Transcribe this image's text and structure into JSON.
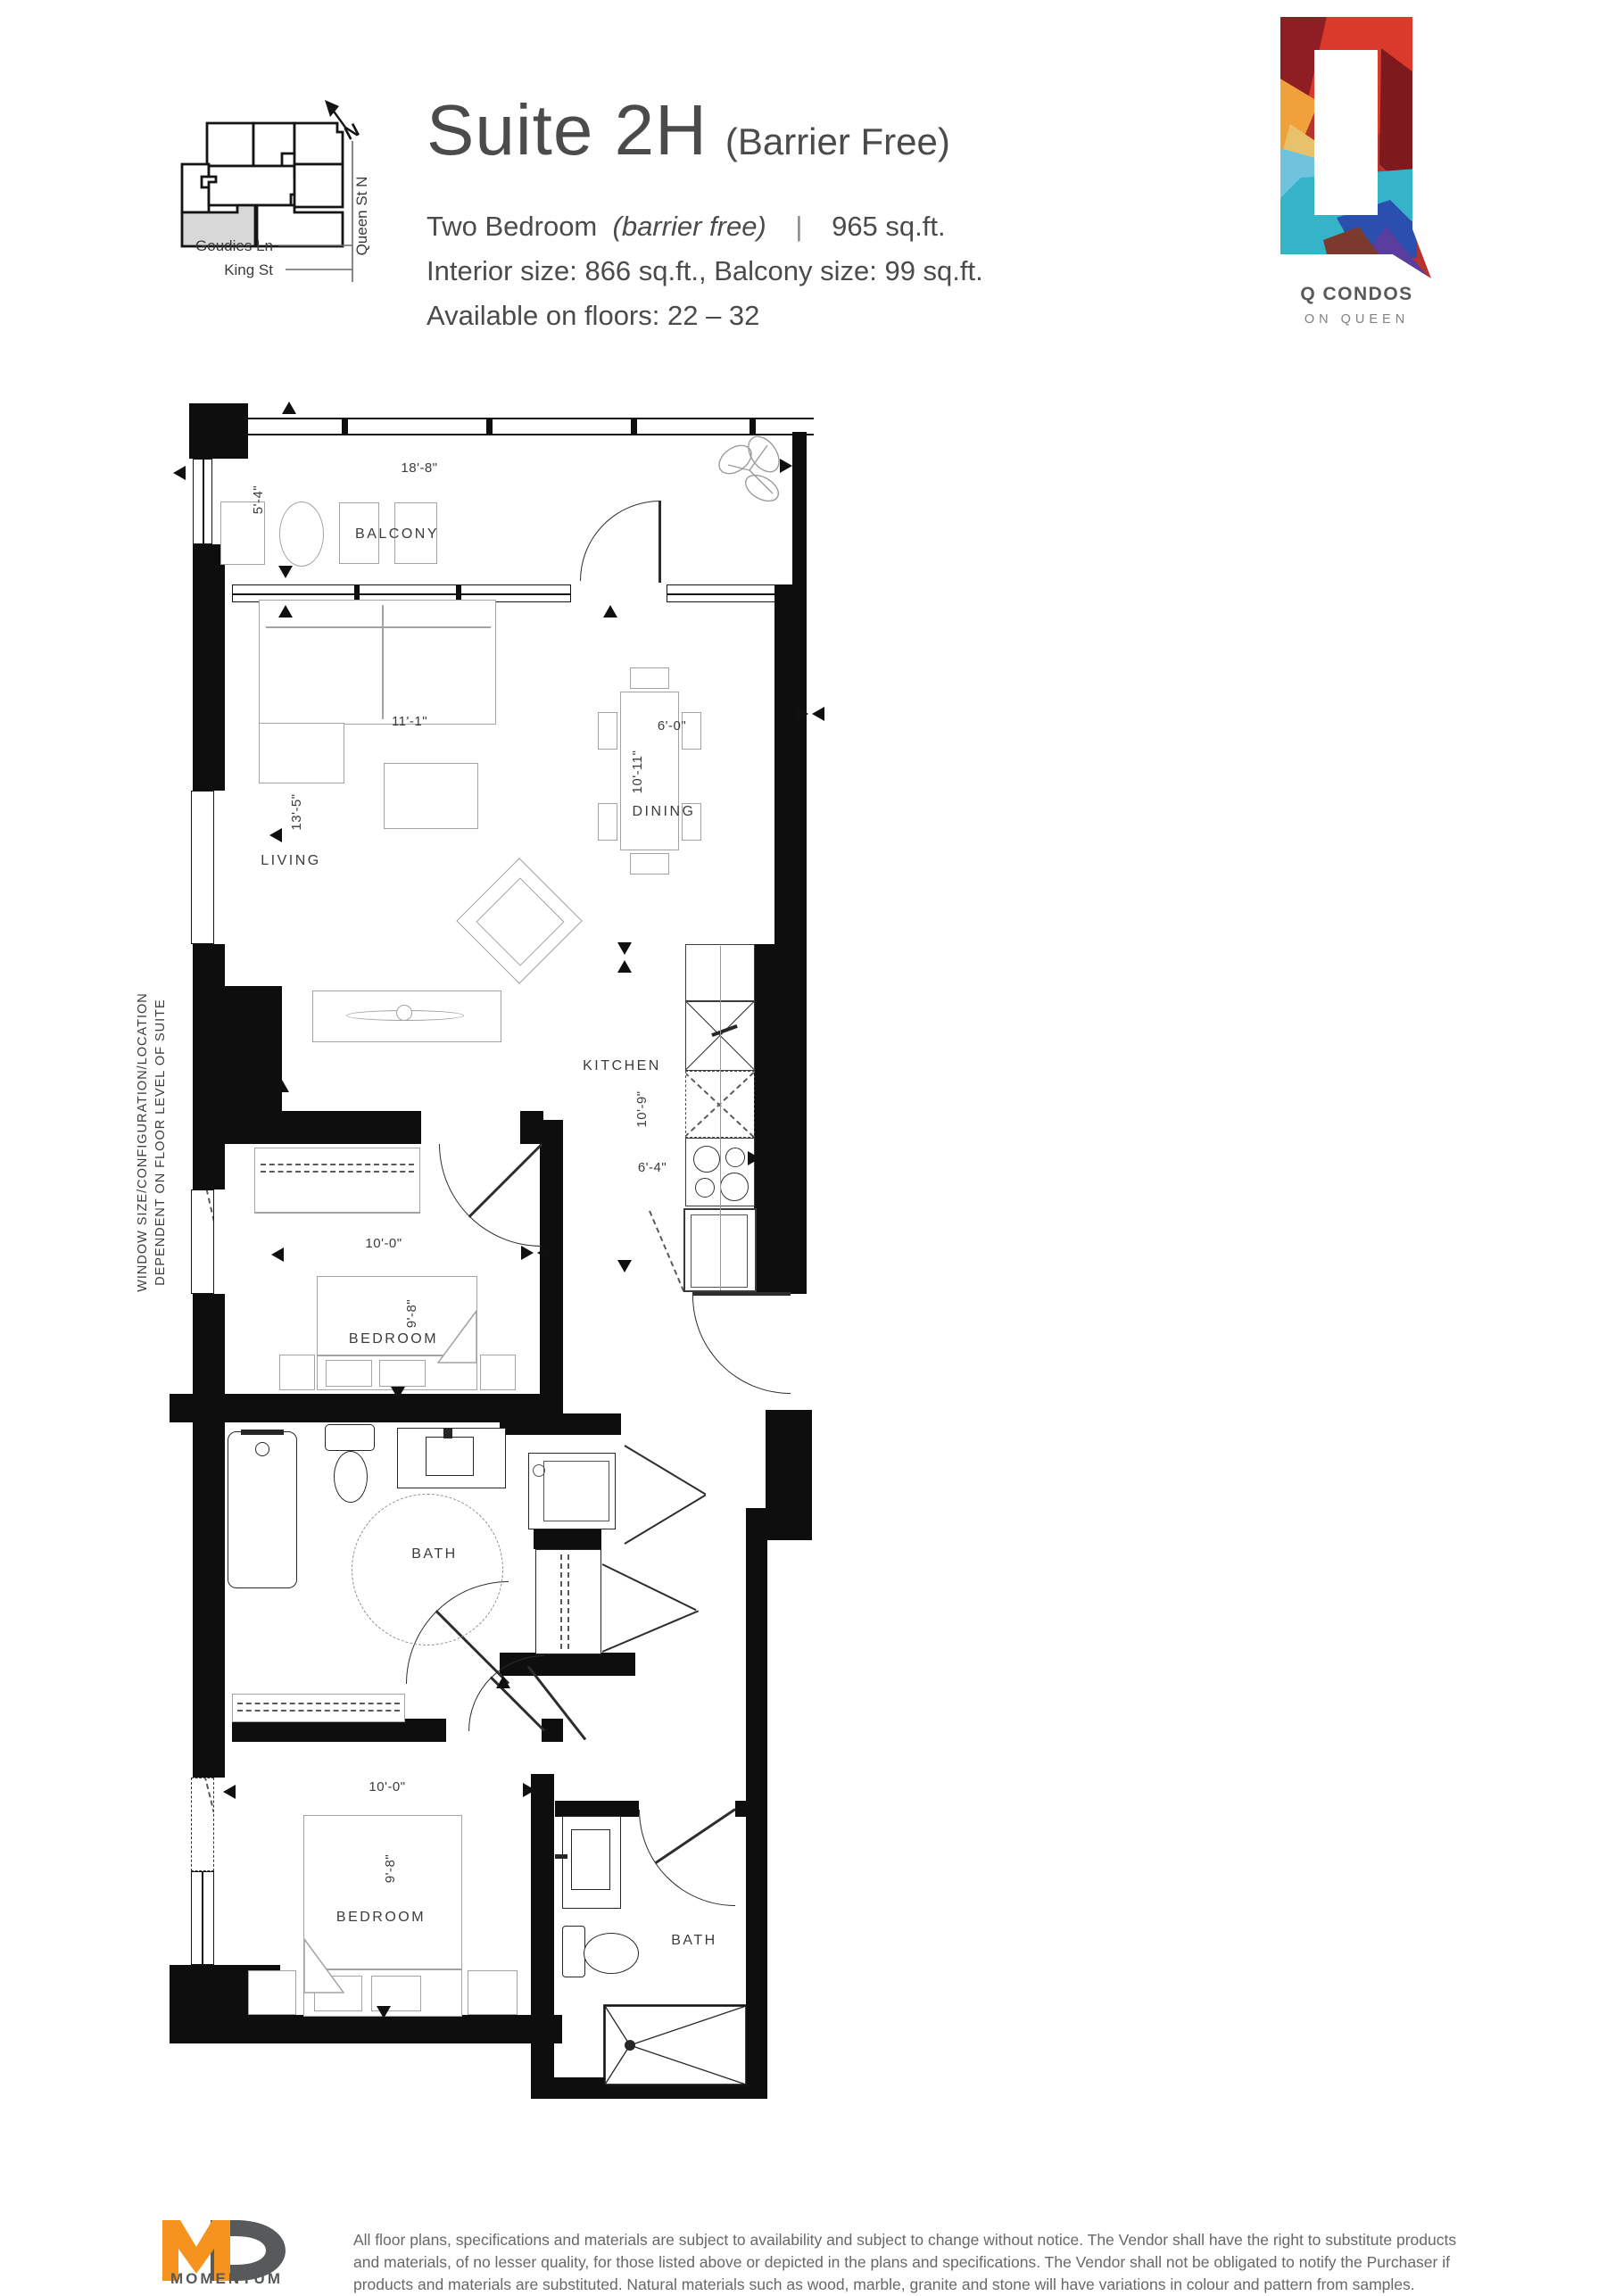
{
  "header": {
    "suite": "Suite 2H",
    "qualifier": "(Barrier Free)",
    "type": "Two Bedroom",
    "type_note": "(barrier free)",
    "separator": "|",
    "area": "965 sq.ft.",
    "sizes": "Interior size: 866 sq.ft., Balcony size: 99 sq.ft.",
    "floors": "Available on floors: 22 – 32"
  },
  "keyplate": {
    "north": "N",
    "streets": {
      "goudies": "Goudies Ln",
      "king": "King St",
      "queen": "Queen St N"
    }
  },
  "brand": {
    "name": "Q CONDOS",
    "tagline": "ON QUEEN"
  },
  "plan": {
    "note": "WINDOW SIZE/CONFIGURATION/LOCATION\nDEPENDENT ON FLOOR LEVEL OF SUITE",
    "balcony": {
      "label": "BALCONY",
      "width": "18'-8\"",
      "depth": "5'-4\""
    },
    "living": {
      "label": "LIVING",
      "width": "11'-1\"",
      "depth": "13'-5\""
    },
    "dining": {
      "label": "DINING",
      "width": "6'-0\"",
      "depth": "10'-11\""
    },
    "kitchen": {
      "label": "KITCHEN",
      "depth": "10'-9\"",
      "width": "6'-4\""
    },
    "bedroom1": {
      "label": "BEDROOM",
      "width": "10'-0\"",
      "depth": "9'-8\""
    },
    "bath1": {
      "label": "BATH"
    },
    "bedroom2": {
      "label": "BEDROOM",
      "width": "10'-0\"",
      "depth": "9'-8\""
    },
    "bath2": {
      "label": "BATH"
    }
  },
  "footer": {
    "brand": "MOMENTUM",
    "disclaimer": "All floor plans, specifications and materials are subject to availability and subject to change without notice.  The Vendor shall have the right to substitute products and materials, of no lesser quality, for those listed above or depicted in the plans and specifications. The Vendor shall not be obligated to notify the Purchaser if products and materials are substituted. Natural materials such as wood, marble, granite and stone will have variations in colour and pattern from samples."
  },
  "colors": {
    "wall": "#0e0e0e",
    "accent_orange": "#F6921E",
    "brand_gray": "#58595B",
    "unit_highlight": "#d8d8d8"
  }
}
